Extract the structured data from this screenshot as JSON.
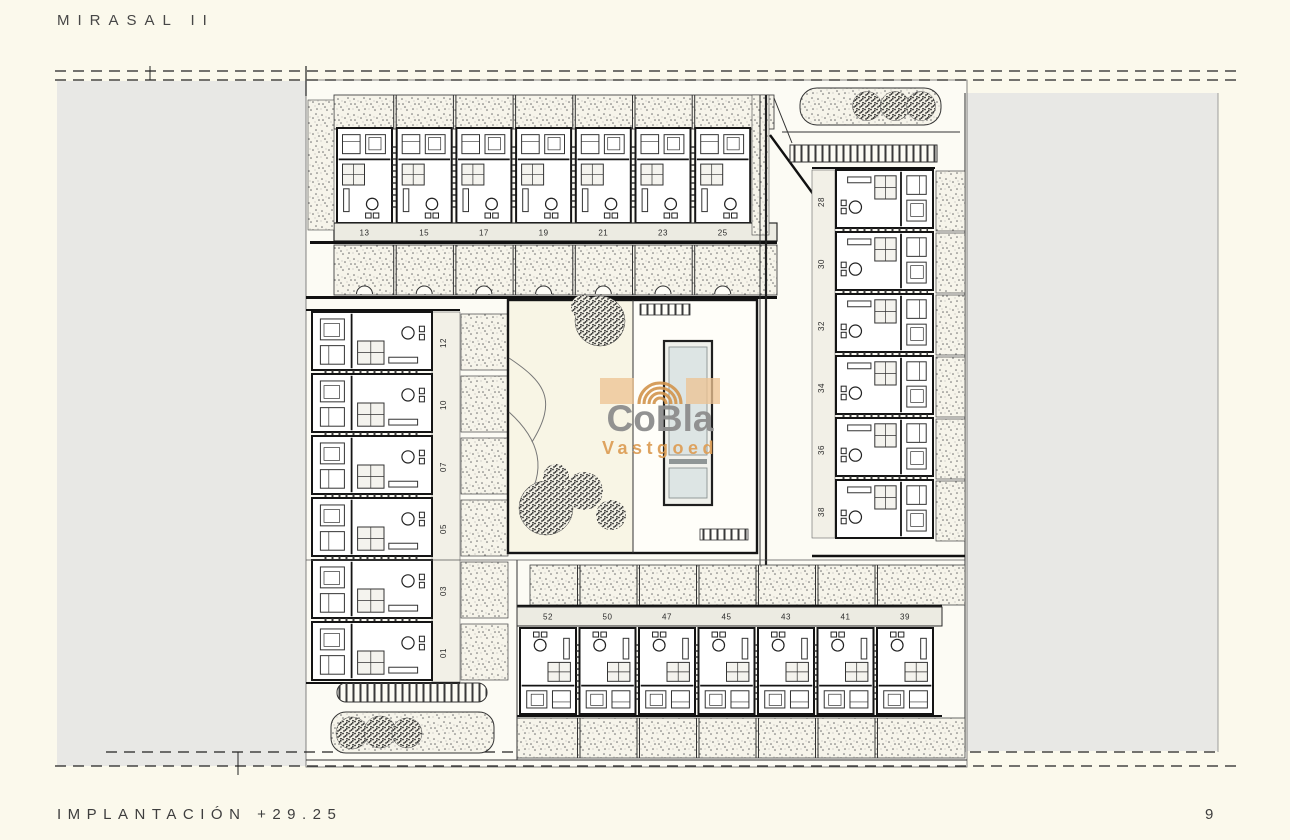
{
  "page": {
    "title": "MIRASAL II",
    "footer_label": "IMPLANTACIÓN +29.25",
    "page_number": "9"
  },
  "watermark": {
    "line1": "CoBla",
    "line2": "Vastgoed",
    "logo": "fingerprint-arcs-icon",
    "text_color": "#8d8d8d",
    "accent_color": "#d2944c"
  },
  "plan": {
    "drawing": "site-implantation-plan",
    "unit_rows": {
      "top": {
        "labels": [
          "13",
          "15",
          "17",
          "19",
          "21",
          "23",
          "25"
        ]
      },
      "left": {
        "labels": [
          "12",
          "10",
          "07",
          "05",
          "03",
          "01"
        ]
      },
      "right": {
        "labels": [
          "28",
          "30",
          "32",
          "34",
          "36",
          "38"
        ]
      },
      "bottom": {
        "labels": [
          "52",
          "50",
          "47",
          "45",
          "43",
          "41",
          "39"
        ]
      }
    },
    "features": {
      "pool": "swimming-pool",
      "courtyard_trees": 6,
      "trees_top_right": 3,
      "trees_bottom_left": 3
    },
    "colors": {
      "background": "#fbf9ec",
      "road_gray": "#e8e8e5",
      "label_band": "#ecebe2",
      "stipple_bg": "#f6f4ea",
      "pool_water": "#dde5e4",
      "line": "#1c1c1c"
    }
  }
}
